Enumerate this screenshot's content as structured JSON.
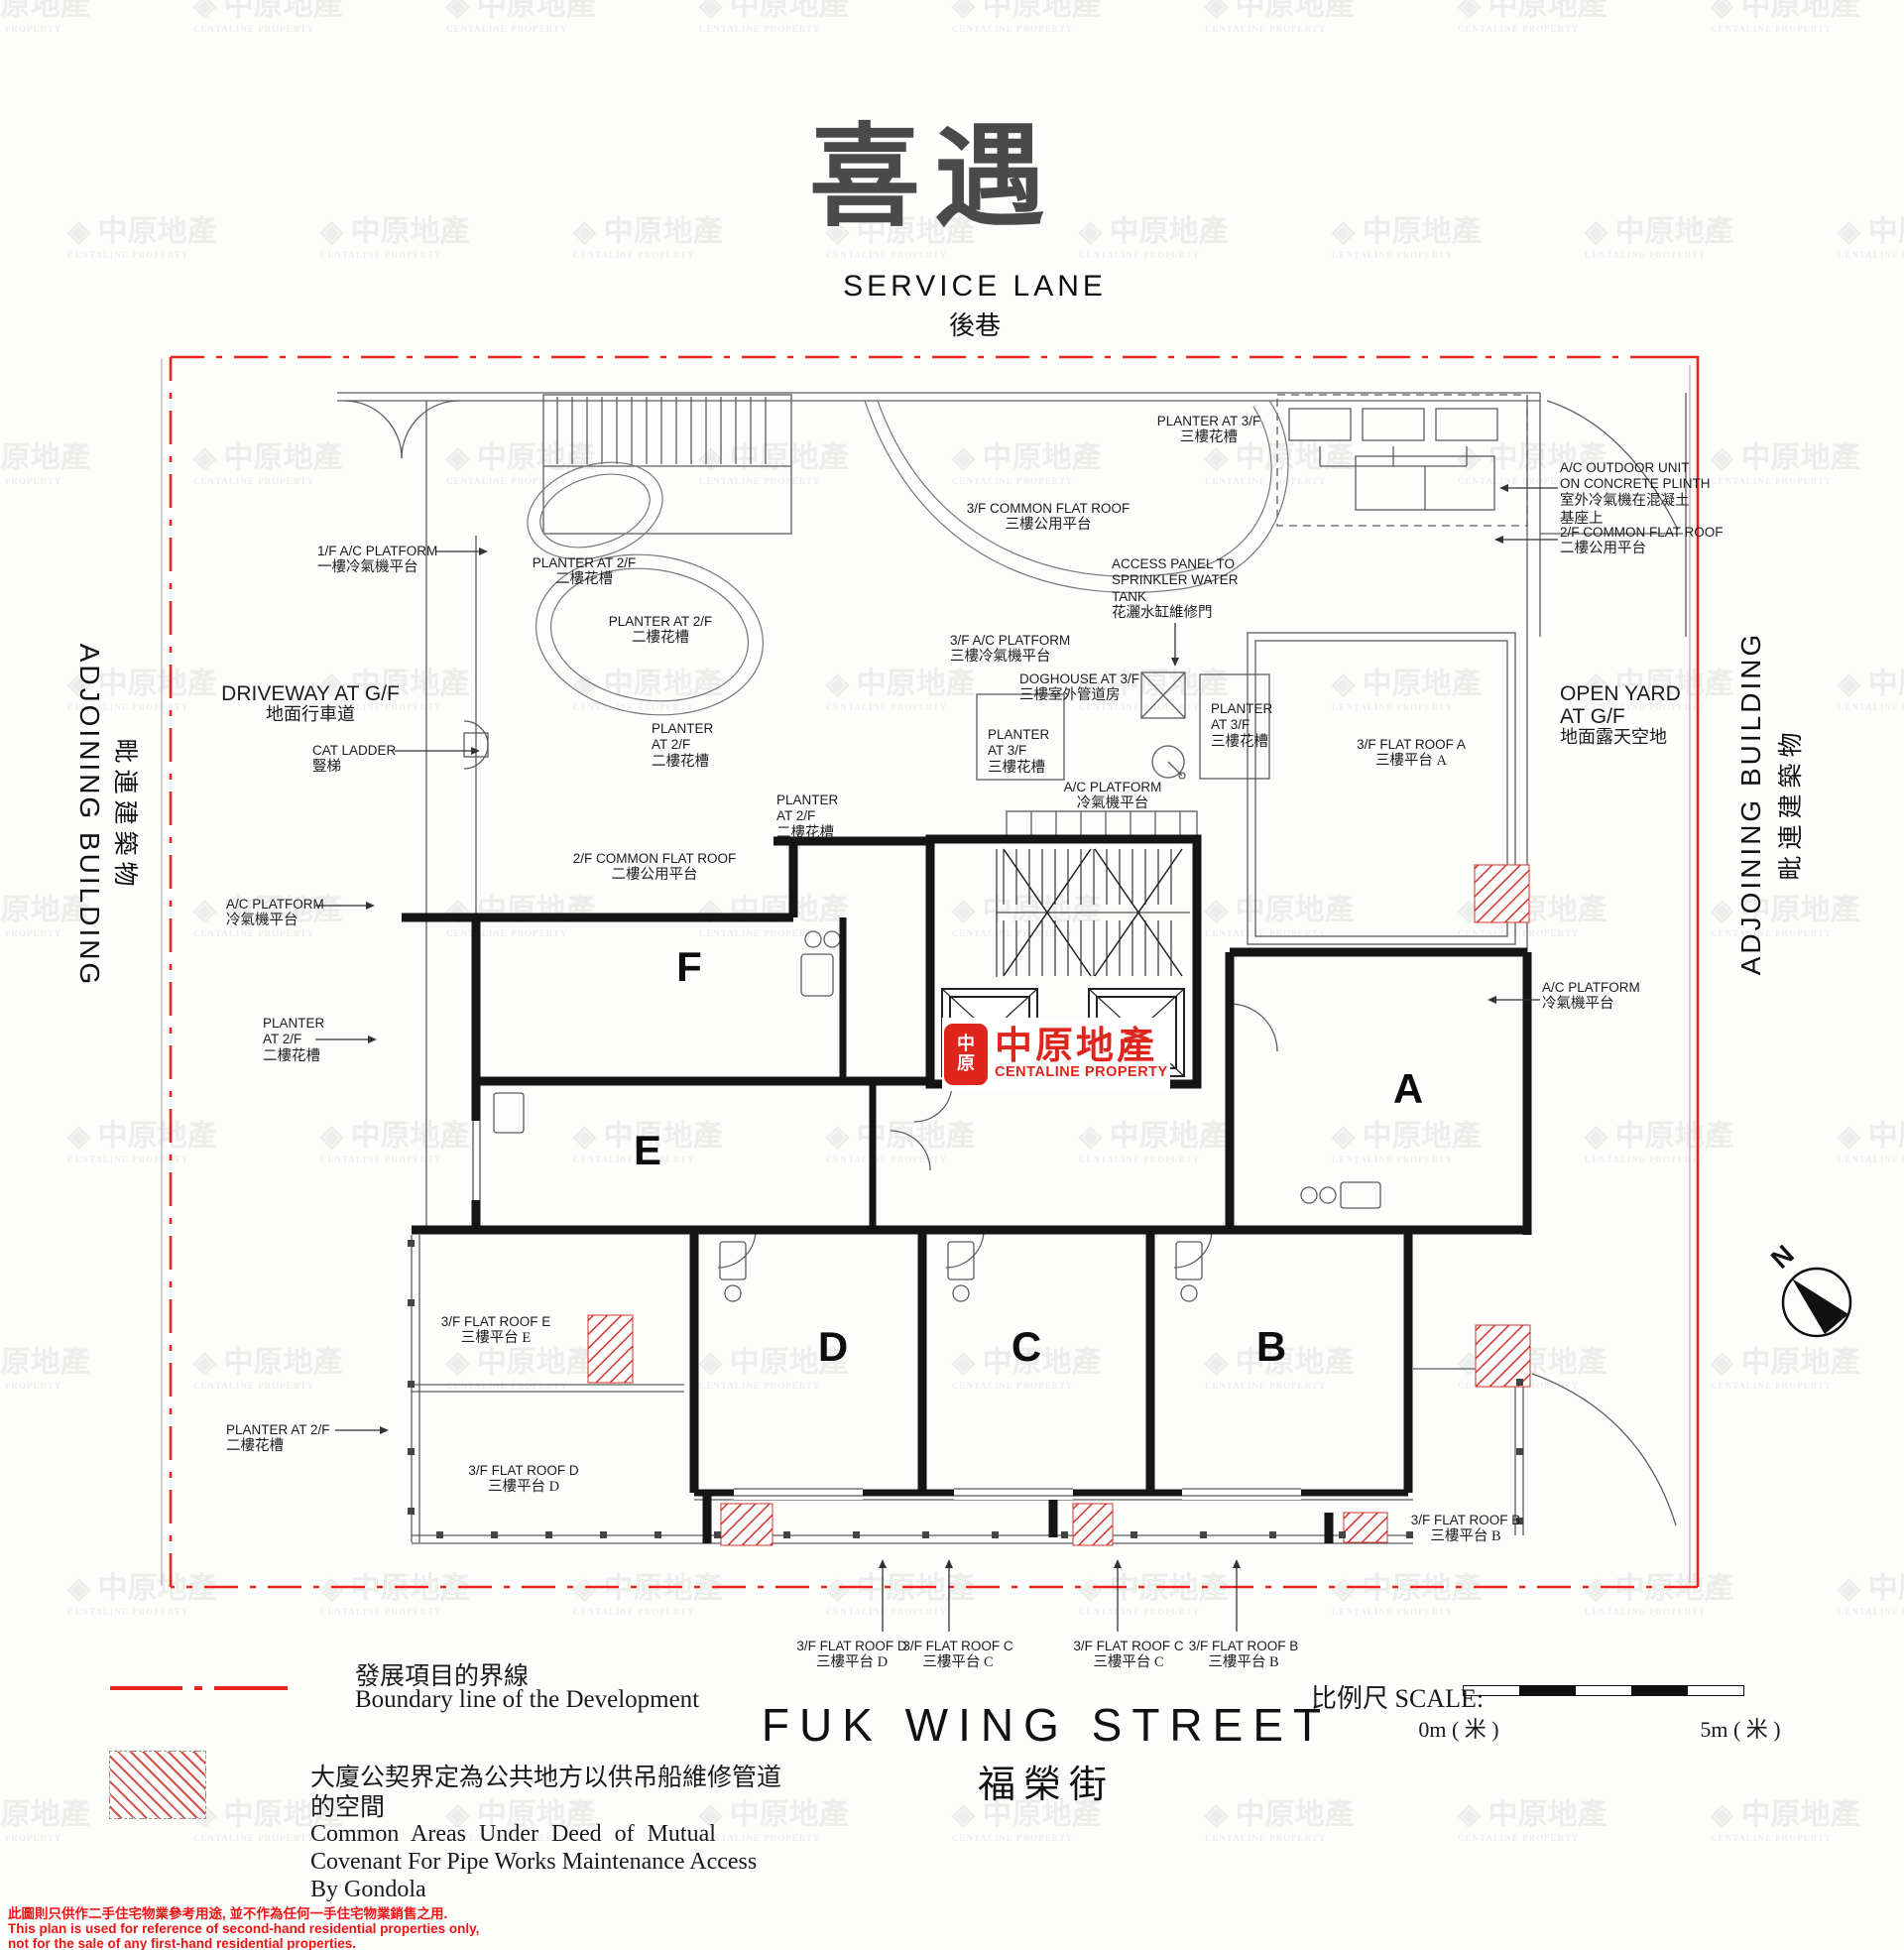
{
  "title": "喜遇",
  "watermark": {
    "zh": "中原地產",
    "en": "CENTALINE PROPERTY"
  },
  "streets": {
    "top": {
      "en": "SERVICE LANE",
      "zh": "後巷"
    },
    "bottom": {
      "en": "FUK  WING  STREET",
      "zh": "福榮街"
    },
    "left": {
      "en": "ADJOINING BUILDING",
      "zh": "毗連建築物"
    },
    "right": {
      "en": "ADJOINING BUILDING",
      "zh": "毗連建築物"
    }
  },
  "logo": {
    "seal_top": "中",
    "seal_bottom": "原",
    "zh": "中原地產",
    "en": "CENTALINE PROPERTY"
  },
  "units": {
    "a": "A",
    "b": "B",
    "c": "C",
    "d": "D",
    "e": "E",
    "f": "F"
  },
  "compass": {
    "n": "N"
  },
  "labels": [
    {
      "en": "PLANTER AT 2/F",
      "zh": "二樓花槽"
    },
    {
      "en": "PLANTER AT 2/F",
      "zh": "二樓花槽"
    },
    {
      "en": "PLANTER\nAT 2/F",
      "zh": "二樓花槽"
    },
    {
      "en": "PLANTER\nAT 2/F",
      "zh": "二樓花槽"
    },
    {
      "en": "1/F A/C PLATFORM",
      "zh": "一樓冷氣機平台"
    },
    {
      "en": "DRIVEWAY AT G/F",
      "zh": "地面行車道"
    },
    {
      "en": "CAT LADDER",
      "zh": "豎梯"
    },
    {
      "en": "A/C PLATFORM",
      "zh": "冷氣機平台"
    },
    {
      "en": "PLANTER\nAT 2/F",
      "zh": "二樓花槽"
    },
    {
      "en": "2/F COMMON FLAT ROOF",
      "zh": "二樓公用平台"
    },
    {
      "en": "PLANTER AT 3/F",
      "zh": "三樓花槽"
    },
    {
      "en": "3/F COMMON FLAT ROOF",
      "zh": "三樓公用平台"
    },
    {
      "en": "ACCESS PANEL TO\nSPRINKLER WATER\nTANK",
      "zh": "花灑水缸維修門"
    },
    {
      "en": "3/F A/C PLATFORM",
      "zh": "三樓冷氣機平台"
    },
    {
      "en": "DOGHOUSE AT 3/F",
      "zh": "三樓室外管道房"
    },
    {
      "en": "PLANTER\nAT 3/F",
      "zh": "三樓花槽"
    },
    {
      "en": "PLANTER\nAT 3/F",
      "zh": "三樓花槽"
    },
    {
      "en": "A/C PLATFORM",
      "zh": "冷氣機平台"
    },
    {
      "en": "3/F FLAT ROOF A",
      "zh": "三樓平台  A"
    },
    {
      "en": "A/C OUTDOOR UNIT\nON CONCRETE PLINTH",
      "zh": "室外冷氣機在混凝土\n基座上"
    },
    {
      "en": "2/F COMMON FLAT ROOF",
      "zh": "二樓公用平台"
    },
    {
      "en": "OPEN YARD\nAT G/F",
      "zh": "地面露天空地"
    },
    {
      "en": "A/C PLATFORM",
      "zh": "冷氣機平台"
    },
    {
      "en": "3/F FLAT ROOF E",
      "zh": "三樓平台  E"
    },
    {
      "en": "PLANTER AT 2/F",
      "zh": "二樓花槽"
    },
    {
      "en": "3/F FLAT ROOF D",
      "zh": "三樓平台  D"
    },
    {
      "en": "3/F FLAT ROOF B",
      "zh": "三樓平台  B"
    },
    {
      "en": "3/F FLAT ROOF D",
      "zh": "三樓平台  D"
    },
    {
      "en": "3/F FLAT ROOF C",
      "zh": "三樓平台  C"
    },
    {
      "en": "3/F FLAT ROOF C",
      "zh": "三樓平台  C"
    },
    {
      "en": "3/F FLAT ROOF B",
      "zh": "三樓平台  B"
    }
  ],
  "legend": {
    "boundary_zh": "發展項目的界線",
    "boundary_en": "Boundary line of the Development",
    "common_zh1": "大廈公契界定為公共地方以供吊船維修管道",
    "common_zh2": "的空間",
    "common_en1": "Common Areas Under Deed of Mutual",
    "common_en2": "Covenant For Pipe Works Maintenance Access",
    "common_en3": "By Gondola"
  },
  "scale": {
    "label": "比例尺 SCALE:",
    "start": "0m ( 米 )",
    "end": "5m ( 米 )"
  },
  "disclaimer": {
    "zh": "此圖則只供作二手住宅物業參考用途, 並不作為任何一手住宅物業銷售之用.",
    "en1": "This plan is used for reference of second-hand residential properties only,",
    "en2": "not for the sale of any first-hand residential properties."
  },
  "colors": {
    "boundary_red": "#e8251f",
    "hatch_red": "#d0342b",
    "logo_red": "#e0251c",
    "wall_black": "#151515"
  }
}
